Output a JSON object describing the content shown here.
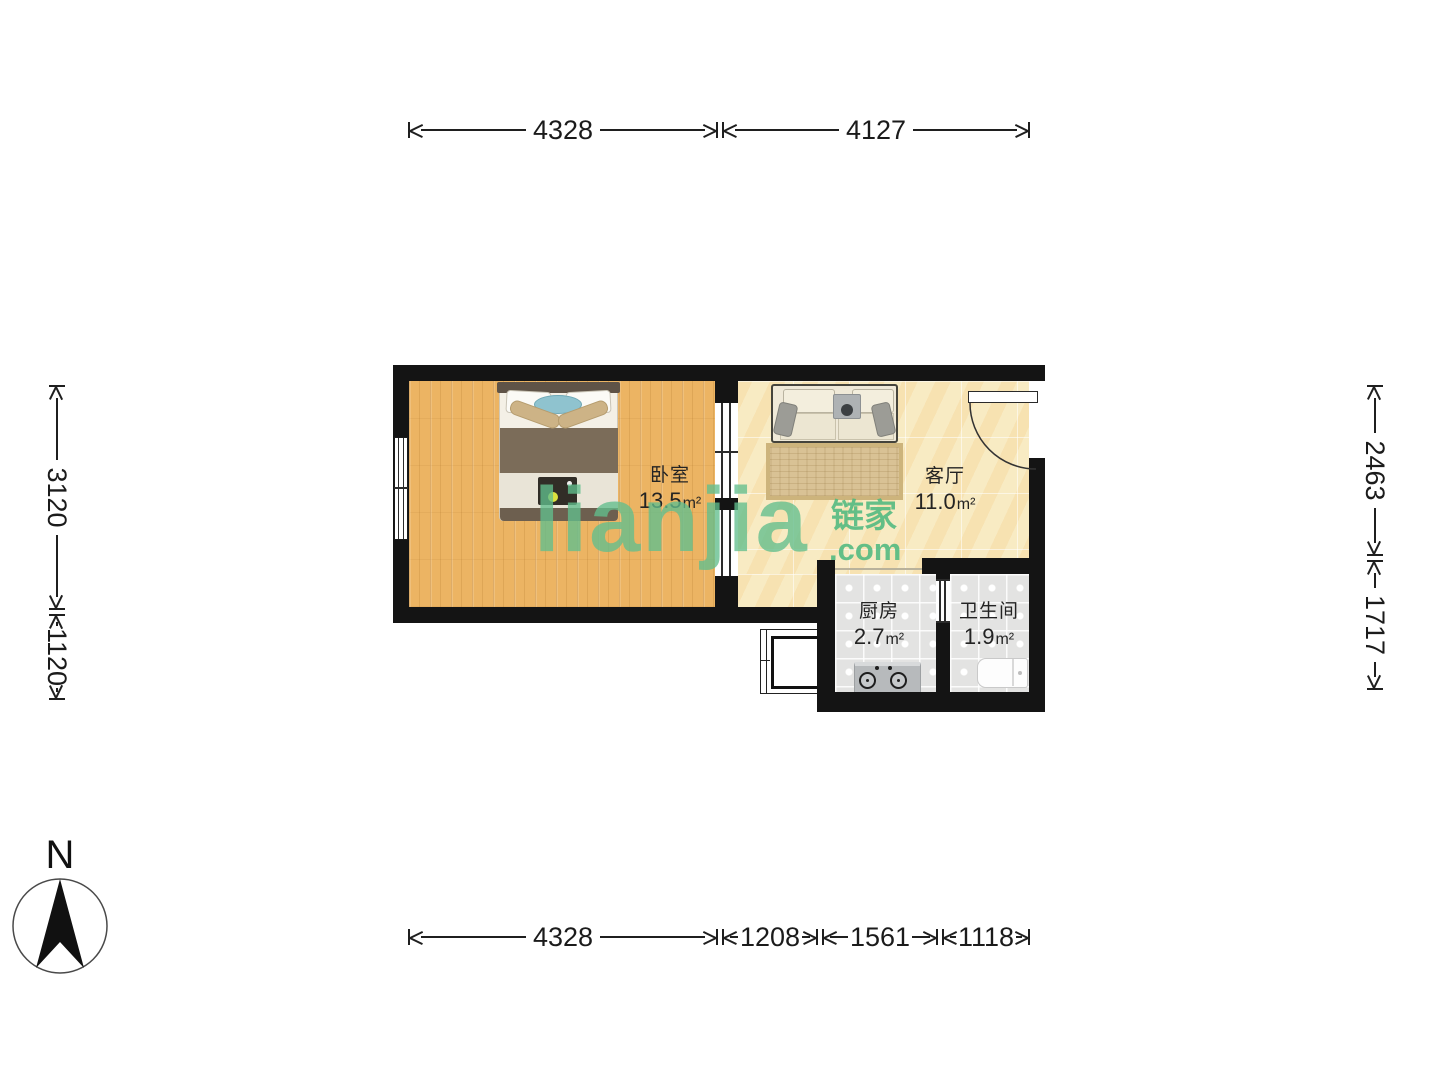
{
  "compass": {
    "north_label": "N"
  },
  "watermark": {
    "logo_text": "lianjia",
    "logo_cn": "链家",
    "logo_suffix": ".com"
  },
  "rooms": [
    {
      "id": "bedroom",
      "name": "卧室",
      "area": "13.5",
      "unit": "m²"
    },
    {
      "id": "living",
      "name": "客厅",
      "area": "11.0",
      "unit": "m²"
    },
    {
      "id": "kitchen",
      "name": "厨房",
      "area": "2.7",
      "unit": "m²"
    },
    {
      "id": "bathroom",
      "name": "卫生间",
      "area": "1.9",
      "unit": "m²"
    }
  ],
  "dimensions_mm": {
    "top": [
      "4328",
      "4127"
    ],
    "bottom": [
      "4328",
      "1208",
      "1561",
      "1118"
    ],
    "left": [
      "3120",
      "1120"
    ],
    "right": [
      "2463",
      "1717"
    ]
  },
  "colors": {
    "wall": "#141414",
    "wood_floor": "#ecb463",
    "stone_floor": "#f8eac3",
    "tile_floor": "#e3e3e2",
    "watermark_green": "#5cbd8d"
  }
}
